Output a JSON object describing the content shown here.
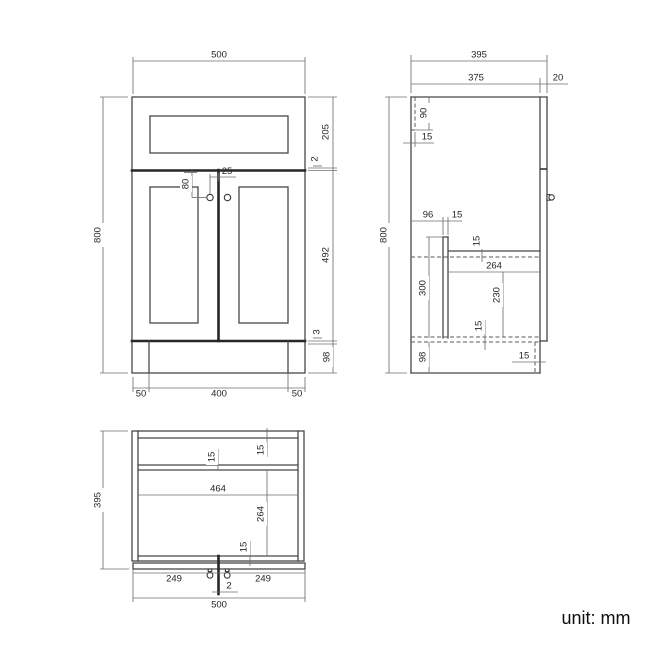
{
  "unit_note": "unit: mm",
  "front_view": {
    "overall_width": "500",
    "overall_height": "800",
    "drawer_front_height": "205",
    "drawer_door_gap": "2",
    "door_height": "492",
    "door_bottom_gap": "3",
    "plinth_height": "98",
    "knob_drop": "80",
    "knob_offset": "25",
    "plinth_inset_left": "50",
    "plinth_width": "400",
    "plinth_inset_right": "50"
  },
  "side_view": {
    "overall_depth": "395",
    "body_depth": "375",
    "door_thickness": "20",
    "overall_height": "800",
    "drawer_box_height": "90",
    "drawer_back_gap": "15",
    "shelf_back_offset": "96",
    "partition_thickness": "15",
    "shelf_thickness": "15",
    "shelf_depth": "264",
    "partition_height": "300",
    "shelf_clearance": "230",
    "bottom_shelf_thickness": "15",
    "plinth_height": "98",
    "plinth_recess": "15"
  },
  "plan_view": {
    "overall_depth": "395",
    "top_rail_thickness": "15",
    "back_panel_thickness": "15",
    "internal_width": "464",
    "internal_depth": "264",
    "bottom_rail_thickness": "15",
    "door_width_left": "249",
    "door_width_right": "249",
    "door_gap": "2",
    "overall_width": "500"
  }
}
